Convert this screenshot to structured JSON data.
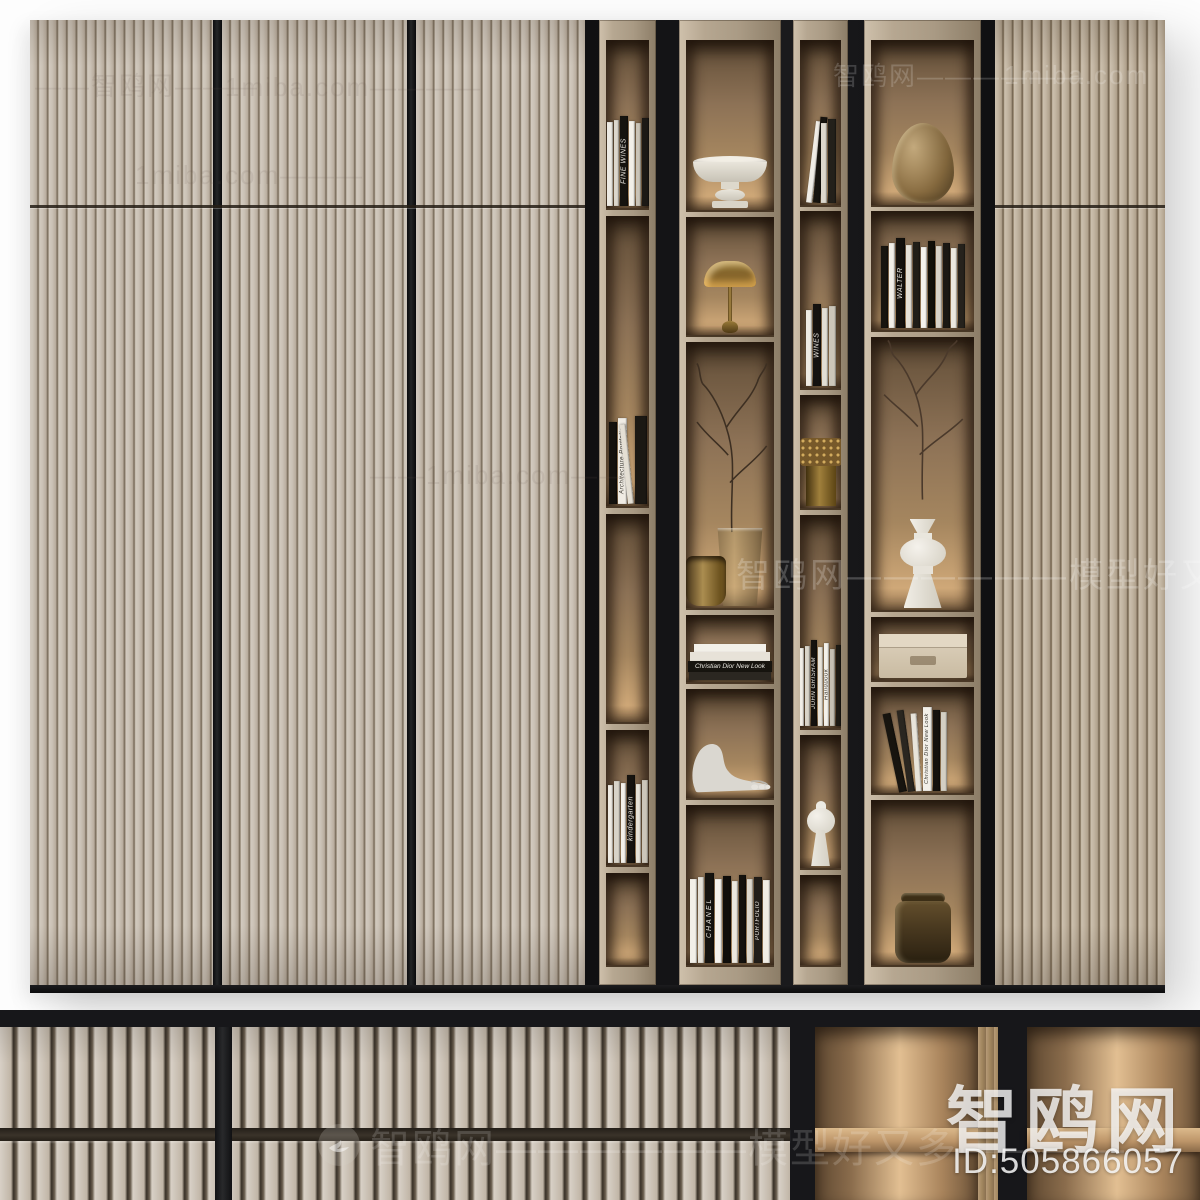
{
  "watermarks": {
    "brand": "智鸥网",
    "id_text": "ID:505866057",
    "center": "智鸥网——————模型好又多——",
    "strip": "智鸥网——————模型好又多————",
    "tiles": [
      "——智鸥网———",
      "1miba.com————",
      "1miba.com———",
      "智鸥网——————",
      "1miba.com",
      "——1miba.com——"
    ]
  },
  "book_spines": {
    "fine_wines": "FINE WINES",
    "architecture_portfolio": "Architecture Portfolio",
    "kindergarten": "kindergarten",
    "chanel": "CHANEL",
    "portfolio": "PORTFOLIO",
    "walter": "WALTER",
    "john_grisham": "JOHN GRISHAM",
    "handbook": "Handbook",
    "dior": "Christian Dior New Look",
    "wines": "WINES"
  },
  "colors": {
    "door_wood": "#cbc2b6",
    "niche_wood": "#a5865f",
    "accent_black": "#141416",
    "frame_wood": "#b6a791",
    "background": "#ffffff",
    "watermark_white": "#fafafa"
  }
}
